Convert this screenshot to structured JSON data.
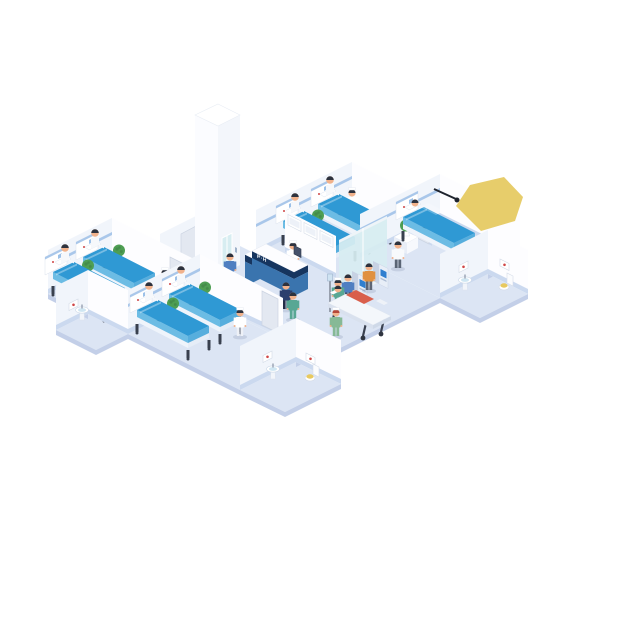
{
  "title": "Isometric hospital ward floor illustration",
  "desk_sign": "P·H",
  "colors": {
    "floor": "#dce5f4",
    "floorEdge": "#c3cfe8",
    "baseboard": "#cbd9ef",
    "accent": "#a9c7ea",
    "glass": "#d7edf1",
    "screenBlue": "#2f7fd0",
    "bedTop": "#2f99d4",
    "bedSide": "#6cbce4",
    "bedSideD": "#57aedd",
    "legDark": "#39404e",
    "deskNavy": "#16355f",
    "deskBlue": "#3a74ae",
    "plantGreen": "#4e9e53",
    "sinkBlue": "#cfe6f2",
    "toiletSeat": "#e8c95f",
    "lampYellow": "#e7cd6b",
    "doorGray": "#e3e8f1",
    "gurneyBlanket": "#d95f4c",
    "skin": "#f1b28c",
    "hair": "#2d323e",
    "scrubTeal": "#58a794",
    "scrubGreen": "#86b996",
    "coatWhite": "#f8fafc",
    "patientOrange": "#e0913f",
    "patientBlue": "#4f7fc1",
    "workerNavy": "#2c3f6e",
    "pantsDark": "#5a6575"
  },
  "scene": {
    "description": "Isometric cutaway illustration of a hospital ward floor with patient rooms, corridor, nurse station, check-in kiosks, elevator, stretcher and staff",
    "rooms": [
      {
        "name": "ward room top",
        "beds": 2,
        "patients": 2,
        "nurses": 1,
        "plants": 1,
        "door": true
      },
      {
        "name": "ward room right",
        "beds": 1,
        "patients": 1,
        "doctors": 1,
        "plants": 1,
        "ceiling_light": true
      },
      {
        "name": "ward room mid-left",
        "beds": 2,
        "patients": 2,
        "nurses": 1,
        "plants": 2
      },
      {
        "name": "ward room bottom-left",
        "beds": 2,
        "patients": 2,
        "nurses": 1,
        "plants": 2,
        "door": true
      }
    ],
    "bathrooms": [
      {
        "location": "mid-left",
        "fixtures": [
          "sink",
          "mirror"
        ]
      },
      {
        "location": "bottom-left",
        "fixtures": [
          "sink",
          "toilet",
          "mirror"
        ]
      },
      {
        "location": "right",
        "fixtures": [
          "sink",
          "toilet",
          "mirror"
        ]
      }
    ],
    "corridor": {
      "nurse_station": {
        "sign": "P·H",
        "staff": 1,
        "wall_monitors": 3,
        "computer": 1
      },
      "self_checkin_kiosks": {
        "count": 2,
        "users": 2
      },
      "elevator": {
        "doors": 1,
        "people_waiting": 1
      },
      "stretcher": {
        "patients": 1,
        "nurses": 1
      },
      "walking_people": 3
    }
  }
}
